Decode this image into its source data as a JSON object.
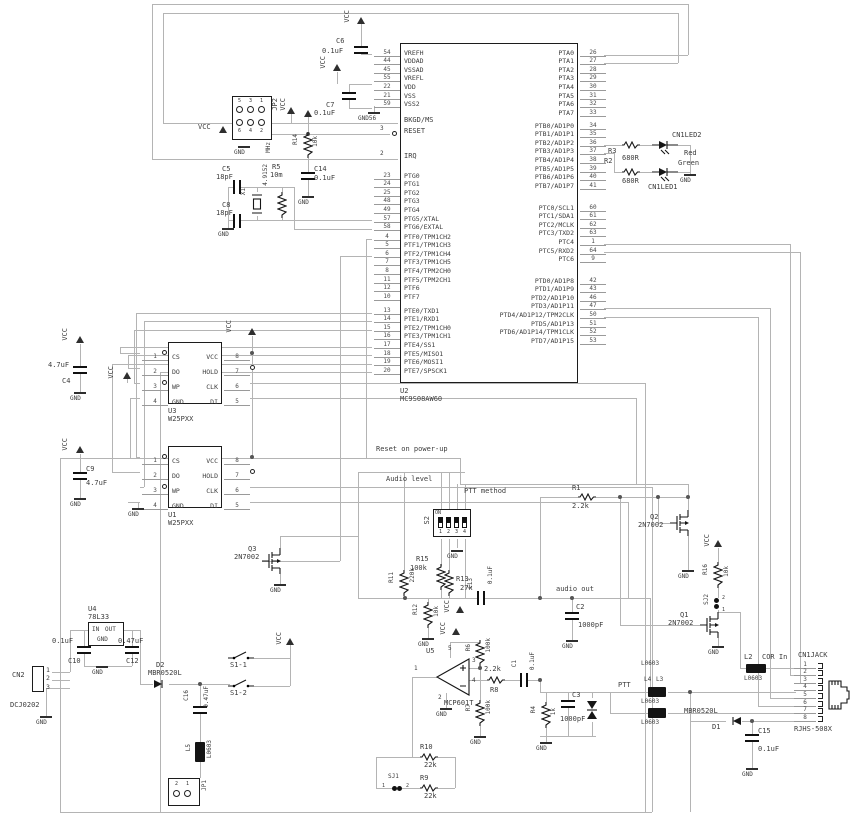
{
  "colors": {
    "wire": "#b4b4b4",
    "ink": "#161616",
    "text": "#3c3c3c"
  },
  "nets": {
    "vcc": "VCC",
    "gnd": "GND",
    "gnd56": "GND56",
    "on": "ON",
    "mhz": "MHz"
  },
  "notes": {
    "reset": "Reset on power-up",
    "audio_level": "Audio level",
    "ptt_method": "PTT method",
    "audio_out": "audio out",
    "ptt": "PTT",
    "cor_in": "COR In"
  },
  "mcu": {
    "ref": "U2",
    "part": "MC9S08AW60",
    "bkgd": "BKGD/MS",
    "reset": {
      "n": "3",
      "name": "RESET"
    },
    "irq": {
      "n": "2",
      "name": "IRQ"
    },
    "pwr": [
      {
        "n": "54",
        "name": "VREFH"
      },
      {
        "n": "44",
        "name": "VDDAD"
      },
      {
        "n": "45",
        "name": "VSSAD"
      },
      {
        "n": "55",
        "name": "VREFL"
      },
      {
        "n": "22",
        "name": "VDD"
      },
      {
        "n": "21",
        "name": "VSS"
      },
      {
        "n": "59",
        "name": "VSS2"
      }
    ],
    "ptg": [
      {
        "n": "23",
        "name": "PTG0"
      },
      {
        "n": "24",
        "name": "PTG1"
      },
      {
        "n": "25",
        "name": "PTG2"
      },
      {
        "n": "48",
        "name": "PTG3"
      },
      {
        "n": "49",
        "name": "PTG4"
      },
      {
        "n": "57",
        "name": "PTG5/XTAL"
      },
      {
        "n": "58",
        "name": "PTG6/EXTAL"
      }
    ],
    "ptf": [
      {
        "n": "4",
        "name": "PTF0/TPM1CH2"
      },
      {
        "n": "5",
        "name": "PTF1/TPM1CH3"
      },
      {
        "n": "6",
        "name": "PTF2/TPM1CH4"
      },
      {
        "n": "7",
        "name": "PTF3/TPM1CH5"
      },
      {
        "n": "8",
        "name": "PTF4/TPM2CH0"
      },
      {
        "n": "11",
        "name": "PTF5/TPM2CH1"
      },
      {
        "n": "12",
        "name": "PTF6"
      },
      {
        "n": "10",
        "name": "PTF7"
      }
    ],
    "pte": [
      {
        "n": "13",
        "name": "PTE0/TXD1"
      },
      {
        "n": "14",
        "name": "PTE1/RXD1"
      },
      {
        "n": "15",
        "name": "PTE2/TPM1CH0"
      },
      {
        "n": "16",
        "name": "PTE3/TPM1CH1"
      },
      {
        "n": "17",
        "name": "PTE4/SS1"
      },
      {
        "n": "18",
        "name": "PTE5/MISO1"
      },
      {
        "n": "19",
        "name": "PTE6/MOSI1"
      },
      {
        "n": "20",
        "name": "PTE7/SPSCK1"
      }
    ],
    "pta": [
      {
        "n": "26",
        "name": "PTA0"
      },
      {
        "n": "27",
        "name": "PTA1"
      },
      {
        "n": "28",
        "name": "PTA2"
      },
      {
        "n": "29",
        "name": "PTA3"
      },
      {
        "n": "30",
        "name": "PTA4"
      },
      {
        "n": "31",
        "name": "PTA5"
      },
      {
        "n": "32",
        "name": "PTA6"
      },
      {
        "n": "33",
        "name": "PTA7"
      }
    ],
    "ptb": [
      {
        "n": "34",
        "name": "PTB0/AD1P0"
      },
      {
        "n": "35",
        "name": "PTB1/AD1P1"
      },
      {
        "n": "36",
        "name": "PTB2/AD1P2"
      },
      {
        "n": "37",
        "name": "PTB3/AD1P3"
      },
      {
        "n": "38",
        "name": "PTB4/AD1P4"
      },
      {
        "n": "39",
        "name": "PTB5/AD1P5"
      },
      {
        "n": "40",
        "name": "PTB6/AD1P6"
      },
      {
        "n": "41",
        "name": "PTB7/AD1P7"
      }
    ],
    "ptc": [
      {
        "n": "60",
        "name": "PTC0/SCL1"
      },
      {
        "n": "61",
        "name": "PTC1/SDA1"
      },
      {
        "n": "62",
        "name": "PTC2/MCLK"
      },
      {
        "n": "63",
        "name": "PTC3/TXD2"
      },
      {
        "n": "1",
        "name": "PTC4"
      },
      {
        "n": "64",
        "name": "PTC5/RXD2"
      },
      {
        "n": "9",
        "name": "PTC6"
      }
    ],
    "ptd": [
      {
        "n": "42",
        "name": "PTD0/AD1P8"
      },
      {
        "n": "43",
        "name": "PTD1/AD1P9"
      },
      {
        "n": "46",
        "name": "PTD2/AD1P10"
      },
      {
        "n": "47",
        "name": "PTD3/AD1P11"
      },
      {
        "n": "50",
        "name": "PTD4/AD1P12/TPM2CLK"
      },
      {
        "n": "51",
        "name": "PTD5/AD1P13"
      },
      {
        "n": "52",
        "name": "PTD6/AD1P14/TPM1CLK"
      },
      {
        "n": "53",
        "name": "PTD7/AD1P15"
      }
    ]
  },
  "flash": {
    "u3": {
      "ref": "U3",
      "part": "W25PXX"
    },
    "u1": {
      "ref": "U1",
      "part": "W25PXX"
    },
    "l": [
      {
        "n": "1",
        "name": "CS"
      },
      {
        "n": "2",
        "name": "DO"
      },
      {
        "n": "3",
        "name": "WP"
      },
      {
        "n": "4",
        "name": "GND"
      }
    ],
    "r": [
      {
        "n": "8",
        "name": "VCC"
      },
      {
        "n": "7",
        "name": "HOLD"
      },
      {
        "n": "6",
        "name": "CLK"
      },
      {
        "n": "5",
        "name": "DI"
      }
    ]
  },
  "jp2": {
    "ref": "JP2",
    "top": [
      "5",
      "3",
      "1"
    ],
    "bot": [
      "6",
      "4",
      "2"
    ]
  },
  "jp1": {
    "ref": "JP1",
    "pins": [
      "2",
      "1"
    ]
  },
  "cn2": {
    "ref": "CN2",
    "part": "DCJ0202",
    "pins": [
      "1",
      "2",
      "3"
    ]
  },
  "jack": {
    "ref": "CN1JACK",
    "part": "RJHS-508X",
    "pins": [
      "1",
      "2",
      "3",
      "4",
      "5",
      "6",
      "7",
      "8"
    ]
  },
  "s2": {
    "ref": "S2",
    "nums": [
      "1",
      "2",
      "3",
      "4"
    ]
  },
  "parts": {
    "c6": {
      "ref": "C6",
      "val": "0.1uF"
    },
    "c7": {
      "ref": "C7",
      "val": "0.1uF"
    },
    "c14": {
      "ref": "C14",
      "val": "0.1uF"
    },
    "c5": {
      "ref": "C5",
      "val": "18pF"
    },
    "c8": {
      "ref": "C8",
      "val": "18pF"
    },
    "c4": {
      "ref": "C4",
      "val": "4.7uF"
    },
    "c9": {
      "ref": "C9",
      "val": "4.7uF"
    },
    "c13": {
      "ref": "C13",
      "val": "0.1uF"
    },
    "c2": {
      "ref": "C2",
      "val": "1000pF"
    },
    "c10": {
      "ref": "C10",
      "val": "0.1uF"
    },
    "c12": {
      "ref": "C12",
      "val": "0.47uF"
    },
    "c16": {
      "ref": "C16",
      "val": "0.47uF"
    },
    "c1": {
      "ref": "C1",
      "val": "0.1uF"
    },
    "c3": {
      "ref": "C3",
      "val": "1000pF"
    },
    "c15": {
      "ref": "C15",
      "val": "0.1uF"
    },
    "r14": {
      "ref": "R14",
      "val": "10k"
    },
    "r5": {
      "ref": "R5",
      "val": "10m"
    },
    "r3": {
      "ref": "R3",
      "val": "680R"
    },
    "r2": {
      "ref": "R2",
      "val": "680R"
    },
    "r15": {
      "ref": "R15",
      "val": "100k"
    },
    "r13": {
      "ref": "R13",
      "val": "27k"
    },
    "r11": {
      "ref": "R11",
      "val": "220k"
    },
    "r12": {
      "ref": "R12",
      "val": "10k"
    },
    "r1": {
      "ref": "R1",
      "val": "2.2k"
    },
    "r16": {
      "ref": "R16",
      "val": "10k"
    },
    "r6": {
      "ref": "R6",
      "val": "100k"
    },
    "r7": {
      "ref": "R7",
      "val": "100k"
    },
    "r8": {
      "ref": "R8",
      "val": "2.2k"
    },
    "r4": {
      "ref": "R4",
      "val": "1k"
    },
    "r10": {
      "ref": "R10",
      "val": "22k"
    },
    "r9": {
      "ref": "R9",
      "val": "22k"
    },
    "x1": {
      "ref": "X1",
      "val": "4.9152"
    },
    "d2": {
      "ref": "D2",
      "val": "MBR0520L"
    },
    "d1": {
      "ref": "D1",
      "val": "MBR0520L"
    },
    "q1": {
      "ref": "Q1",
      "val": "2N7002"
    },
    "q2": {
      "ref": "Q2",
      "val": "2N7002"
    },
    "q3": {
      "ref": "Q3",
      "val": "2N7002"
    },
    "u4": {
      "ref": "U4",
      "part": "78L33",
      "pin_in": "IN",
      "pin_out": "OUT",
      "pin_gnd": "GND"
    },
    "u5": {
      "ref": "U5",
      "part": "MCP601T",
      "p1": "1",
      "p2": "2",
      "p3": "3",
      "p4": "4",
      "p5": "5"
    },
    "l5": {
      "ref": "L5",
      "val": "L0603"
    },
    "l4": {
      "ref": "L4",
      "val": "L0603"
    },
    "l3": {
      "ref": "L3",
      "val": "L0603"
    },
    "l2": {
      "ref": "L2",
      "val": "L0603"
    },
    "s1a": {
      "ref": "S1-1"
    },
    "s1b": {
      "ref": "S1-2"
    },
    "sj1": {
      "ref": "SJ1",
      "p1": "1",
      "p2": "2"
    },
    "sj2": {
      "ref": "SJ2",
      "p1": "1",
      "p2": "2"
    },
    "led2": {
      "ref": "CN1LED2",
      "color": "Red"
    },
    "led1": {
      "ref": "CN1LED1",
      "color": "Green"
    }
  }
}
